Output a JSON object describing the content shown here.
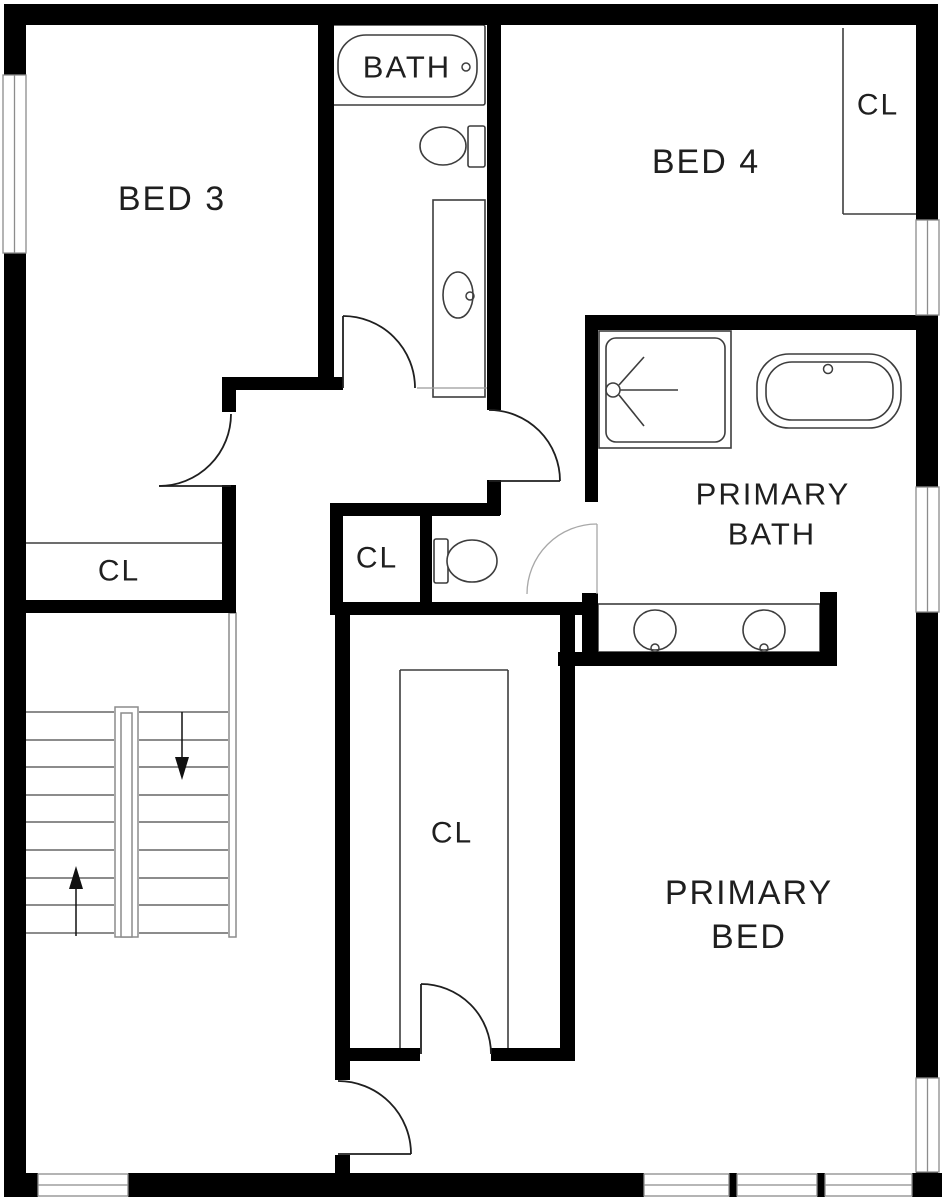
{
  "canvas": {
    "width": 942,
    "height": 1201,
    "background": "#ffffff"
  },
  "colors": {
    "wall": "#000000",
    "fixture_line": "#3d3d3d",
    "light_line": "#9b9b9b",
    "stair_line": "#8c8c8c",
    "door_arc": "#1f1f1f",
    "door_arc_light": "#a8a8a8",
    "arrow": "#111111",
    "window_line": "#8c8c8c",
    "text": "#1f1f1f"
  },
  "labels": [
    {
      "id": "bathtub-label",
      "text": "BATH",
      "x": 407,
      "y": 67,
      "size": 31
    },
    {
      "id": "bed-3-label",
      "text": "BED 3",
      "x": 172,
      "y": 199,
      "size": 34
    },
    {
      "id": "bed-4-label",
      "text": "BED 4",
      "x": 706,
      "y": 162,
      "size": 34
    },
    {
      "id": "bed4-closet-label",
      "text": "CL",
      "x": 878,
      "y": 105,
      "size": 30
    },
    {
      "id": "bed3-closet-label",
      "text": "CL",
      "x": 119,
      "y": 571,
      "size": 30
    },
    {
      "id": "hall-closet-label",
      "text": "CL",
      "x": 377,
      "y": 558,
      "size": 30
    },
    {
      "id": "walkin-closet-label",
      "text": "CL",
      "x": 452,
      "y": 833,
      "size": 30
    },
    {
      "id": "primary-bath-label-1",
      "text": "PRIMARY",
      "x": 773,
      "y": 494,
      "size": 31
    },
    {
      "id": "primary-bath-label-2",
      "text": "BATH",
      "x": 772,
      "y": 534,
      "size": 31
    },
    {
      "id": "primary-bed-label-1",
      "text": "PRIMARY",
      "x": 749,
      "y": 893,
      "size": 34
    },
    {
      "id": "primary-bed-label-2",
      "text": "BED",
      "x": 749,
      "y": 937,
      "size": 34
    }
  ],
  "walls": {
    "exterior": [
      {
        "name": "wall-left-upper",
        "x": 4,
        "y": 4,
        "w": 22,
        "h": 71
      },
      {
        "name": "wall-left-lower",
        "x": 4,
        "y": 253,
        "w": 22,
        "h": 944
      },
      {
        "name": "wall-top",
        "x": 4,
        "y": 4,
        "w": 934,
        "h": 21
      },
      {
        "name": "wall-right-1",
        "x": 916,
        "y": 4,
        "w": 22,
        "h": 216
      },
      {
        "name": "wall-right-2",
        "x": 916,
        "y": 315,
        "w": 22,
        "h": 172
      },
      {
        "name": "wall-right-3",
        "x": 916,
        "y": 612,
        "w": 22,
        "h": 466
      },
      {
        "name": "wall-right-4",
        "x": 916,
        "y": 1172,
        "w": 22,
        "h": 25
      },
      {
        "name": "wall-bottom-left-corner",
        "x": 4,
        "y": 1173,
        "w": 34,
        "h": 24
      },
      {
        "name": "wall-bottom-main",
        "x": 128,
        "y": 1173,
        "w": 516,
        "h": 24
      },
      {
        "name": "window-mullion-1",
        "x": 729,
        "y": 1173,
        "w": 8,
        "h": 24
      },
      {
        "name": "window-mullion-2",
        "x": 817,
        "y": 1173,
        "w": 8,
        "h": 24
      },
      {
        "name": "wall-bottom-right-corner",
        "x": 912,
        "y": 1173,
        "w": 30,
        "h": 24
      }
    ],
    "interior": [
      {
        "name": "wall-bath-west",
        "x": 318,
        "y": 25,
        "w": 16,
        "h": 365
      },
      {
        "name": "wall-bath-east",
        "x": 487,
        "y": 25,
        "w": 14,
        "h": 385
      },
      {
        "name": "wall-bed3-south",
        "x": 222,
        "y": 377,
        "w": 121,
        "h": 13
      },
      {
        "name": "wall-bed3-door-pillar",
        "x": 222,
        "y": 377,
        "w": 14,
        "h": 35
      },
      {
        "name": "wall-bed3-east-lower",
        "x": 222,
        "y": 485,
        "w": 14,
        "h": 128
      },
      {
        "name": "wall-bed3-closet-south",
        "x": 26,
        "y": 600,
        "w": 210,
        "h": 13
      },
      {
        "name": "wall-hall-door-stub",
        "x": 487,
        "y": 480,
        "w": 14,
        "h": 35
      },
      {
        "name": "wall-hall-closet-north",
        "x": 330,
        "y": 503,
        "w": 170,
        "h": 13
      },
      {
        "name": "wall-hall-closet-west",
        "x": 330,
        "y": 503,
        "w": 13,
        "h": 110
      },
      {
        "name": "wall-closet-toilet-divide",
        "x": 420,
        "y": 515,
        "w": 12,
        "h": 98
      },
      {
        "name": "wall-toilet-south",
        "x": 330,
        "y": 602,
        "w": 255,
        "h": 13
      },
      {
        "name": "wall-toilet-door-stub",
        "x": 582,
        "y": 593,
        "w": 16,
        "h": 59
      },
      {
        "name": "wall-primary-bath-west",
        "x": 585,
        "y": 315,
        "w": 13,
        "h": 187
      },
      {
        "name": "wall-primary-bath-north",
        "x": 585,
        "y": 315,
        "w": 331,
        "h": 15
      },
      {
        "name": "wall-primary-bath-south",
        "x": 558,
        "y": 652,
        "w": 279,
        "h": 14
      },
      {
        "name": "wall-vanity-east-stub",
        "x": 820,
        "y": 592,
        "w": 17,
        "h": 74
      },
      {
        "name": "wall-walkin-west",
        "x": 335,
        "y": 613,
        "w": 15,
        "h": 467
      },
      {
        "name": "wall-walkin-east",
        "x": 560,
        "y": 612,
        "w": 15,
        "h": 449
      },
      {
        "name": "wall-walkin-south-west",
        "x": 335,
        "y": 1048,
        "w": 85,
        "h": 13
      },
      {
        "name": "wall-walkin-south-east",
        "x": 491,
        "y": 1048,
        "w": 82,
        "h": 13
      },
      {
        "name": "wall-bed-door-stub",
        "x": 335,
        "y": 1155,
        "w": 15,
        "h": 20
      }
    ]
  },
  "windows": [
    {
      "name": "window-bed3-left",
      "x": 3,
      "y": 75,
      "w": 23,
      "h": 178,
      "o": "v"
    },
    {
      "name": "window-bed4-right",
      "x": 916,
      "y": 220,
      "w": 23,
      "h": 95,
      "o": "v"
    },
    {
      "name": "window-primary-bath",
      "x": 916,
      "y": 487,
      "w": 23,
      "h": 125,
      "o": "v"
    },
    {
      "name": "window-primary-bed-east",
      "x": 916,
      "y": 1078,
      "w": 23,
      "h": 94,
      "o": "v"
    },
    {
      "name": "window-bottom-left",
      "x": 38,
      "y": 1174,
      "w": 90,
      "h": 22,
      "o": "h"
    },
    {
      "name": "window-bottom-right-1",
      "x": 644,
      "y": 1174,
      "w": 85,
      "h": 22,
      "o": "h"
    },
    {
      "name": "window-bottom-right-2",
      "x": 737,
      "y": 1174,
      "w": 80,
      "h": 22,
      "o": "h"
    },
    {
      "name": "window-bottom-right-3",
      "x": 825,
      "y": 1174,
      "w": 87,
      "h": 22,
      "o": "h"
    }
  ],
  "doors": [
    {
      "name": "door-bed3",
      "arc": "M 159,486 A 72 72 0 0 0 231,414",
      "leaf": [
        159,
        486,
        231,
        486
      ],
      "light": false
    },
    {
      "name": "door-bath",
      "arc": "M 343,316 A 72 72 0 0 1 415,388",
      "leaf": [
        343,
        316,
        343,
        388
      ],
      "light": false
    },
    {
      "name": "door-hall-suite",
      "arc": "M 489,410 A 71 71 0 0 1 560,481",
      "leaf": [
        489,
        481,
        560,
        481
      ],
      "light": false
    },
    {
      "name": "door-walkin-closet",
      "arc": "M 421,984 A 70 70 0 0 1 491,1054",
      "leaf": [
        421,
        984,
        421,
        1054
      ],
      "light": false
    },
    {
      "name": "door-primary-bed",
      "arc": "M 338,1081 A 73 73 0 0 1 411,1154",
      "leaf": [
        338,
        1154,
        411,
        1154
      ],
      "light": false
    },
    {
      "name": "door-toilet-room",
      "arc": "M 597,524 A 70 70 0 0 0 527,594",
      "leaf": [
        597,
        524,
        597,
        594
      ],
      "light": true
    }
  ],
  "stairs": {
    "tread_ys": [
      712,
      740,
      767,
      795,
      822,
      850,
      878,
      905,
      933
    ],
    "left_run": [
      26,
      114
    ],
    "right_run": [
      139,
      228
    ],
    "rails": [
      {
        "name": "stair-center-rail-outer",
        "x": 115,
        "y": 707,
        "w": 23,
        "h": 230
      },
      {
        "name": "stair-center-rail-inner",
        "x": 121,
        "y": 713,
        "w": 11,
        "h": 224
      },
      {
        "name": "stair-side-rail",
        "x": 229,
        "y": 613,
        "w": 7,
        "h": 324
      }
    ],
    "arrows": [
      {
        "name": "stair-down-arrow",
        "line": [
          182,
          712,
          182,
          761
        ],
        "tip": [
          182,
          780
        ],
        "base_y": 757,
        "half": 7
      },
      {
        "name": "stair-up-arrow",
        "line": [
          76,
          888,
          76,
          936
        ],
        "tip": [
          76,
          866
        ],
        "base_y": 889,
        "half": 7
      }
    ]
  },
  "fixtures": {
    "rects": [
      {
        "name": "bathtub-outer",
        "x": 332,
        "y": 25,
        "w": 153,
        "h": 80,
        "rx": 2
      },
      {
        "name": "bathtub-inner",
        "x": 338,
        "y": 35,
        "w": 139,
        "h": 62,
        "rx": 28
      },
      {
        "name": "bath-vanity-counter",
        "x": 433,
        "y": 200,
        "w": 52,
        "h": 197,
        "rx": 0
      },
      {
        "name": "toilet-tank-bath",
        "x": 468,
        "y": 126,
        "w": 17,
        "h": 41,
        "rx": 2
      },
      {
        "name": "toilet-tank-hall",
        "x": 434,
        "y": 539,
        "w": 14,
        "h": 44,
        "rx": 2
      },
      {
        "name": "shower-outer",
        "x": 599,
        "y": 331,
        "w": 132,
        "h": 117,
        "rx": 0
      },
      {
        "name": "shower-inner",
        "x": 606,
        "y": 338,
        "w": 119,
        "h": 104,
        "rx": 10
      },
      {
        "name": "primary-tub-outer",
        "x": 757,
        "y": 354,
        "w": 144,
        "h": 74,
        "rx": 32
      },
      {
        "name": "primary-tub-inner",
        "x": 766,
        "y": 362,
        "w": 127,
        "h": 58,
        "rx": 26
      },
      {
        "name": "primary-vanity-counter",
        "x": 598,
        "y": 604,
        "w": 222,
        "h": 48,
        "rx": 0
      }
    ],
    "ellipses": [
      {
        "name": "toilet-bowl-bath",
        "cx": 443,
        "cy": 146,
        "rx": 23,
        "ry": 19
      },
      {
        "name": "toilet-bowl-hall",
        "cx": 472,
        "cy": 561,
        "rx": 25,
        "ry": 21
      },
      {
        "name": "bath-sink",
        "cx": 458,
        "cy": 295,
        "rx": 15,
        "ry": 23
      },
      {
        "name": "primary-sink-left",
        "cx": 655,
        "cy": 630,
        "rx": 21,
        "ry": 20
      },
      {
        "name": "primary-sink-right",
        "cx": 764,
        "cy": 630,
        "rx": 21,
        "ry": 20
      }
    ],
    "circles": [
      {
        "name": "bathtub-faucet",
        "cx": 466,
        "cy": 67,
        "r": 4
      },
      {
        "name": "bath-sink-faucet",
        "cx": 470,
        "cy": 296,
        "r": 4
      },
      {
        "name": "primary-tub-faucet",
        "cx": 828,
        "cy": 369,
        "r": 4.5
      },
      {
        "name": "primary-sink-left-faucet",
        "cx": 655,
        "cy": 648,
        "r": 4
      },
      {
        "name": "primary-sink-right-faucet",
        "cx": 764,
        "cy": 648,
        "r": 4
      },
      {
        "name": "shower-head",
        "cx": 613,
        "cy": 390,
        "r": 7
      }
    ],
    "lines": [
      {
        "name": "shower-arm-up",
        "x1": 619,
        "y1": 385,
        "x2": 644,
        "y2": 357
      },
      {
        "name": "shower-arm-mid",
        "x1": 620,
        "y1": 390,
        "x2": 678,
        "y2": 390
      },
      {
        "name": "shower-arm-down",
        "x1": 619,
        "y1": 395,
        "x2": 644,
        "y2": 426
      },
      {
        "name": "bed4-closet-side",
        "x1": 843,
        "y1": 28,
        "x2": 843,
        "y2": 214
      },
      {
        "name": "bed4-closet-front",
        "x1": 843,
        "y1": 214,
        "x2": 916,
        "y2": 214
      },
      {
        "name": "bed3-closet-front",
        "x1": 26,
        "y1": 543,
        "x2": 222,
        "y2": 543
      },
      {
        "name": "walkin-shelf-left",
        "x1": 400,
        "y1": 670,
        "x2": 400,
        "y2": 1048
      },
      {
        "name": "walkin-shelf-top",
        "x1": 400,
        "y1": 670,
        "x2": 508,
        "y2": 670
      },
      {
        "name": "walkin-shelf-right",
        "x1": 508,
        "y1": 670,
        "x2": 508,
        "y2": 1048
      }
    ],
    "light_lines": [
      {
        "name": "bath-threshold",
        "x1": 417,
        "y1": 388,
        "x2": 487,
        "y2": 388
      },
      {
        "name": "bed4-wall-face",
        "x1": 500,
        "y1": 28,
        "x2": 500,
        "y2": 410
      }
    ]
  }
}
